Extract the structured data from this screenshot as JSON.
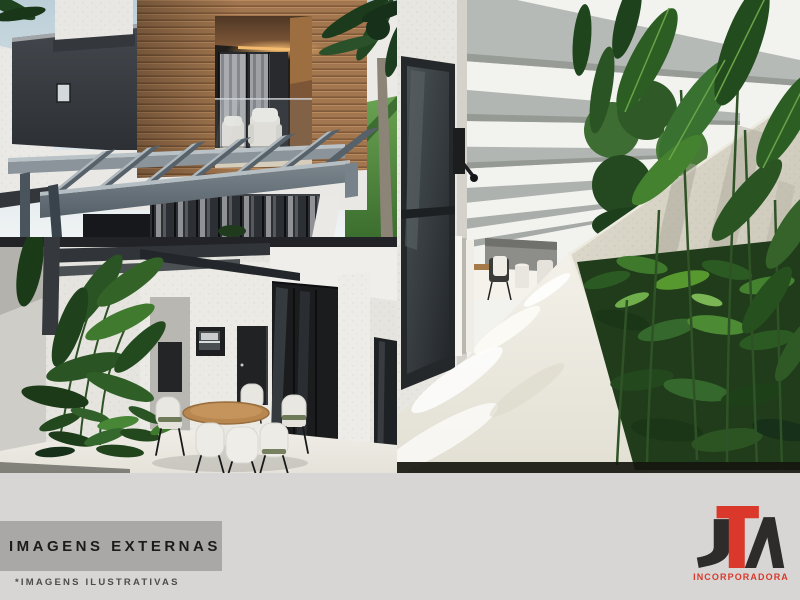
{
  "colors": {
    "band": "#d7d6d4",
    "titlebox": "#a9a8a6",
    "title_text": "#1b1b1b",
    "disclaimer_text": "#4c4c4c",
    "accent": "#d9382b",
    "logo_dark": "#2d2c2b"
  },
  "gallery": {
    "images": [
      {
        "id": "front-facade",
        "alt": "Modern house exterior with cantilevered wooden balcony box, charcoal volume and concrete pergola beams"
      },
      {
        "id": "patio-dining",
        "alt": "Patio with round wooden dining table, white wicker chairs, black framed glass doors and tropical plants"
      },
      {
        "id": "side-corridor",
        "alt": "Side corridor with concrete pergola beams, white textured walls, polished floor and tropical garden bed"
      }
    ]
  },
  "footer": {
    "title": "IMAGENS EXTERNAS",
    "disclaimer": "*IMAGENS ILUSTRATIVAS"
  },
  "logo": {
    "letters": "JTA",
    "subtitle": "INCORPORADORA"
  }
}
